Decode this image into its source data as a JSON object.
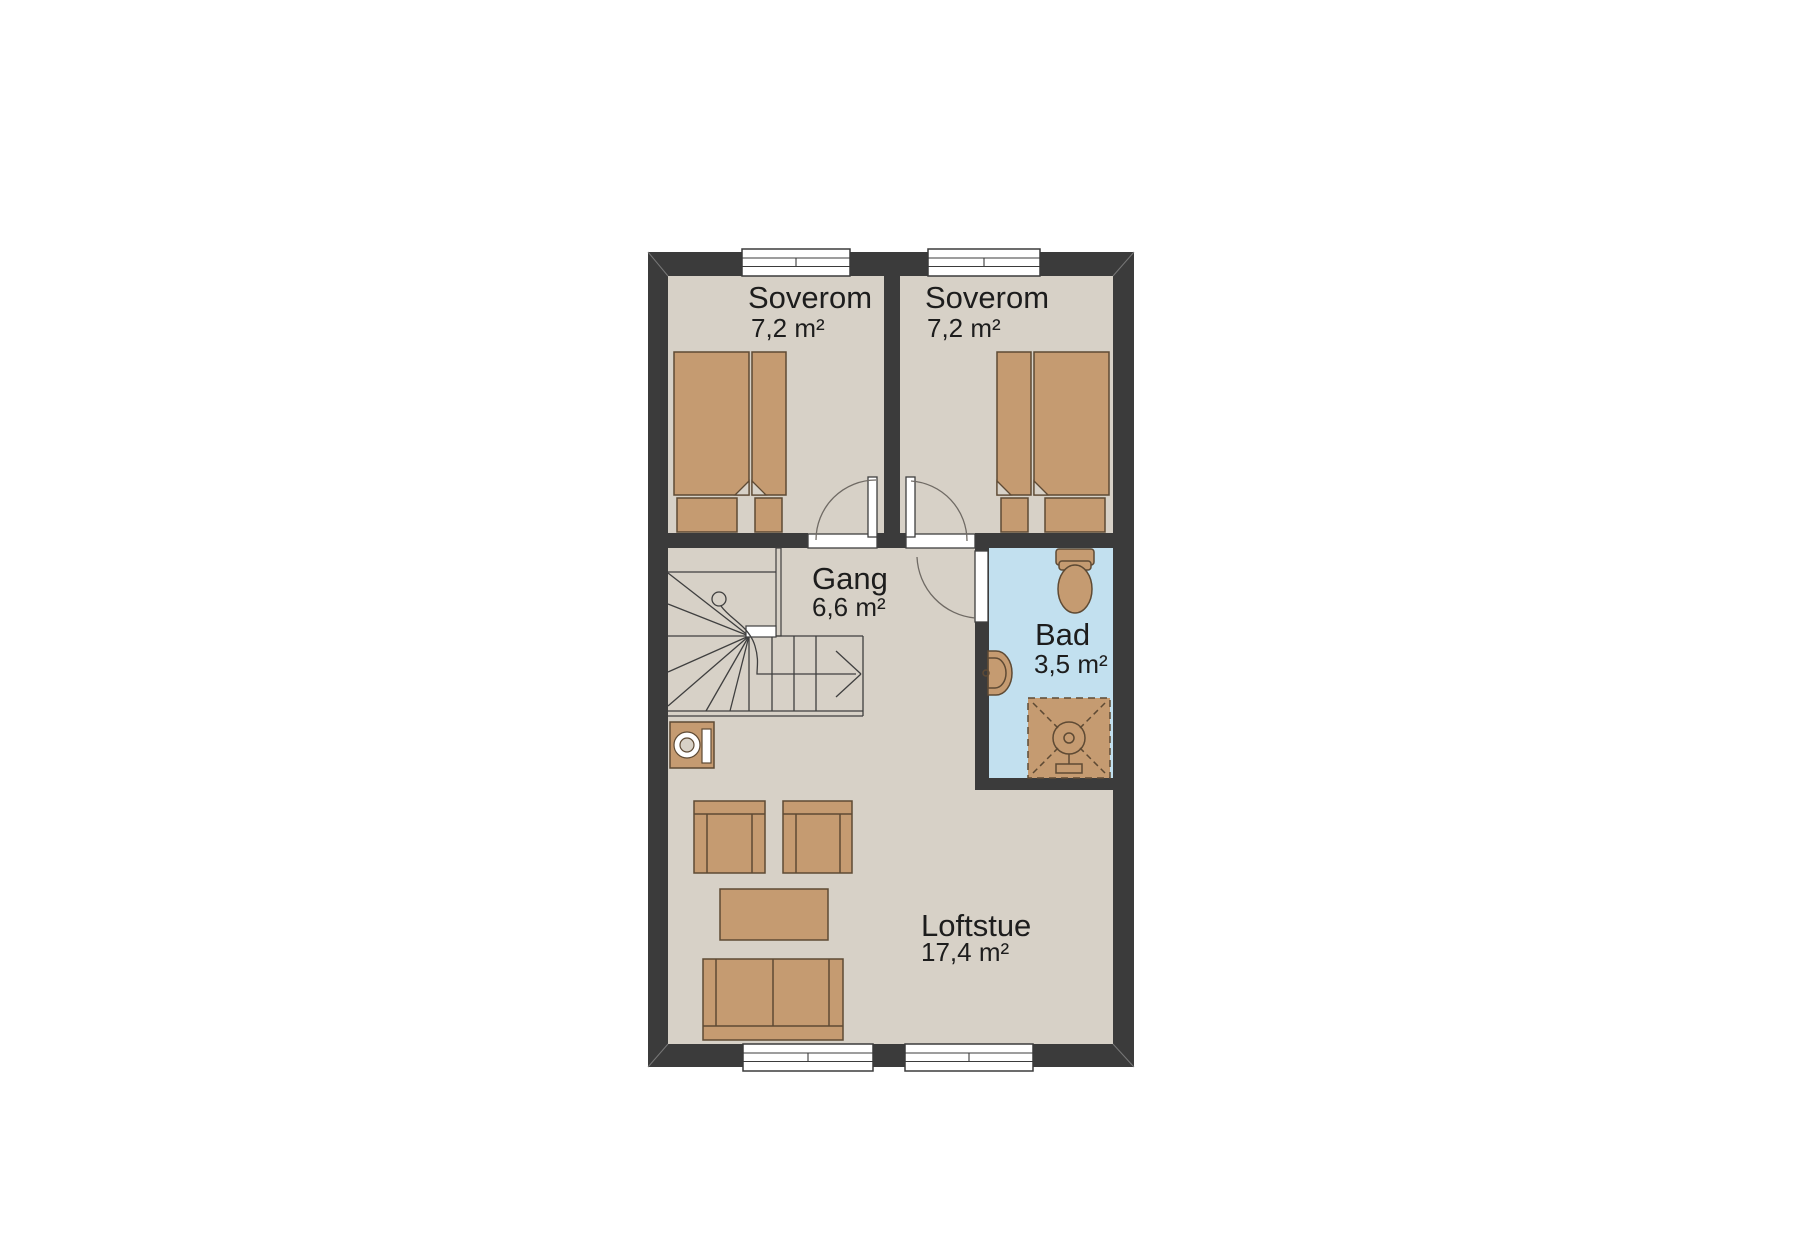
{
  "page": {
    "background": "#ffffff"
  },
  "colors": {
    "wall": "#3b3b3b",
    "wall_light": "#777777",
    "floor": "#d7d1c7",
    "bath_floor": "#c2e0ef",
    "furniture": "#c59b71",
    "furniture_dark": "#5e4a34",
    "window_fill": "#ffffff",
    "line": "#3f3f3f",
    "door_arc": "#6f6a64",
    "text_color": "#1d1d1d"
  },
  "rooms": {
    "soverom1": {
      "name": "Soverom",
      "area": "7,2 m²"
    },
    "soverom2": {
      "name": "Soverom",
      "area": "7,2 m²"
    },
    "gang": {
      "name": "Gang",
      "area": "6,6 m²"
    },
    "bad": {
      "name": "Bad",
      "area": "3,5 m²"
    },
    "loftstue": {
      "name": "Loftstue",
      "area": "17,4 m²"
    }
  }
}
